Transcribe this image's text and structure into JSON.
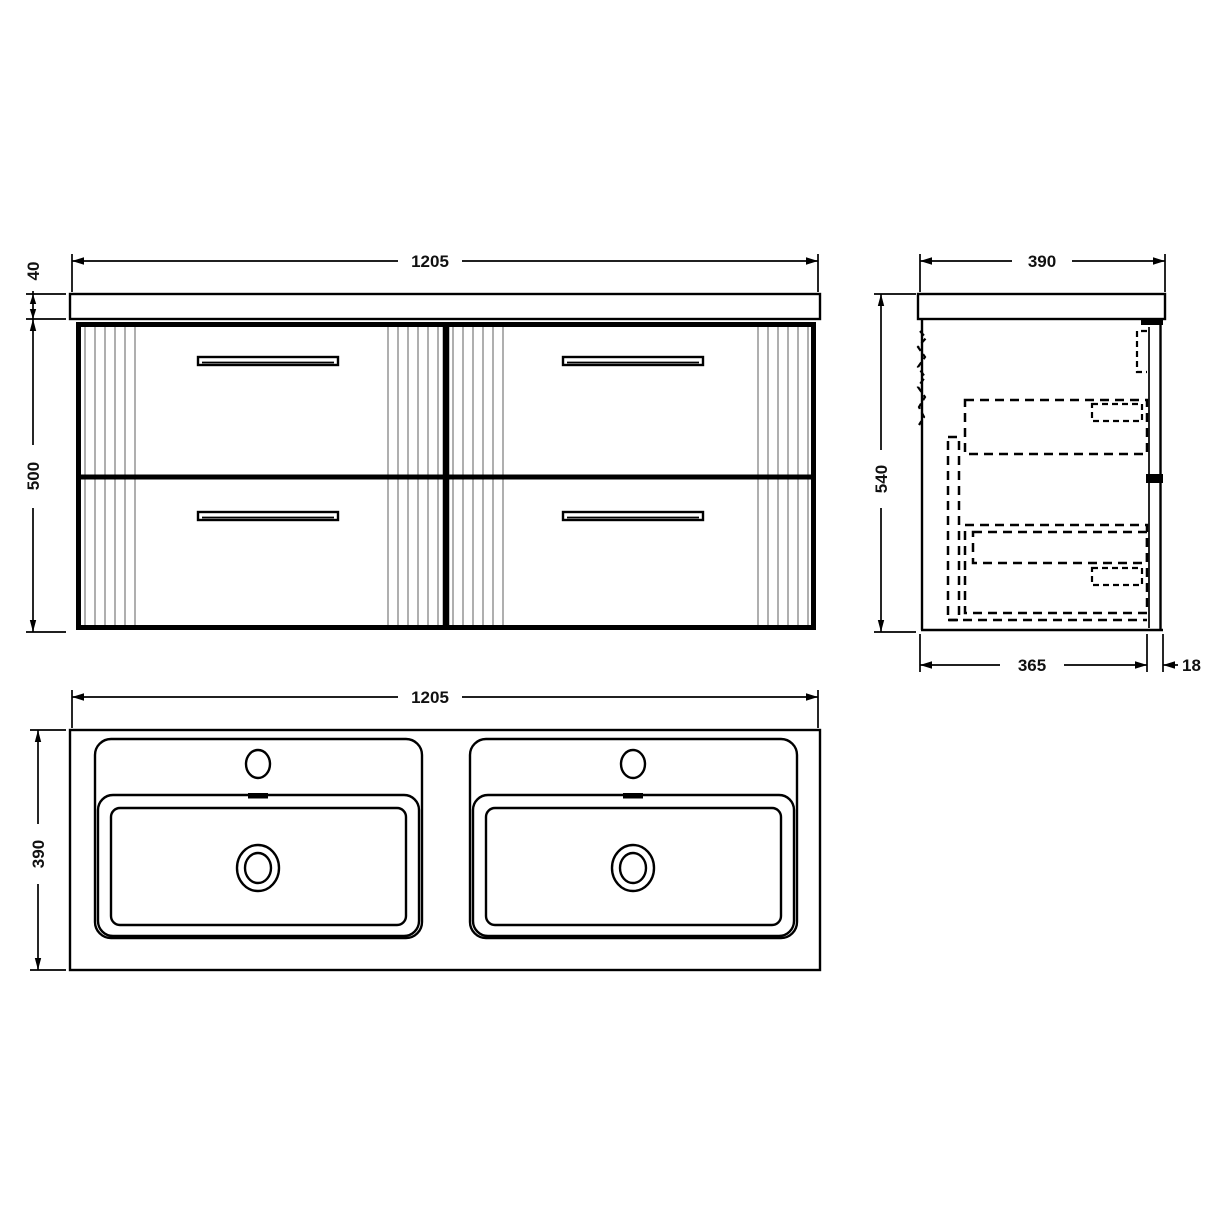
{
  "drawing_type": "technical-dimension-drawing",
  "subject": "wall-hung-double-basin-vanity-unit",
  "colors": {
    "line": "#000000",
    "flute": "#9b9b9b",
    "background": "#ffffff",
    "dim_text": "#111111"
  },
  "views": {
    "front": {
      "label": "front-elevation",
      "dims": {
        "width": "1205",
        "counter_thickness": "40",
        "body_height": "500"
      },
      "features": [
        "countertop",
        "four-drawers",
        "drawer-handles",
        "fluted-pilasters",
        "centre-divider"
      ]
    },
    "side": {
      "label": "side-section",
      "dims": {
        "overall_depth": "390",
        "overall_height": "540",
        "carcass_depth": "365",
        "front_panel_thickness": "18"
      },
      "features": [
        "countertop-overhang",
        "wall-bracket",
        "drawer-boxes-hidden-dashed",
        "drawer-runners-hidden-dashed"
      ]
    },
    "plan": {
      "label": "basin-plan-view",
      "dims": {
        "width": "1205",
        "depth": "390"
      },
      "features": [
        "double-basin",
        "tap-holes",
        "overflow-slots",
        "waste-drains"
      ]
    }
  }
}
